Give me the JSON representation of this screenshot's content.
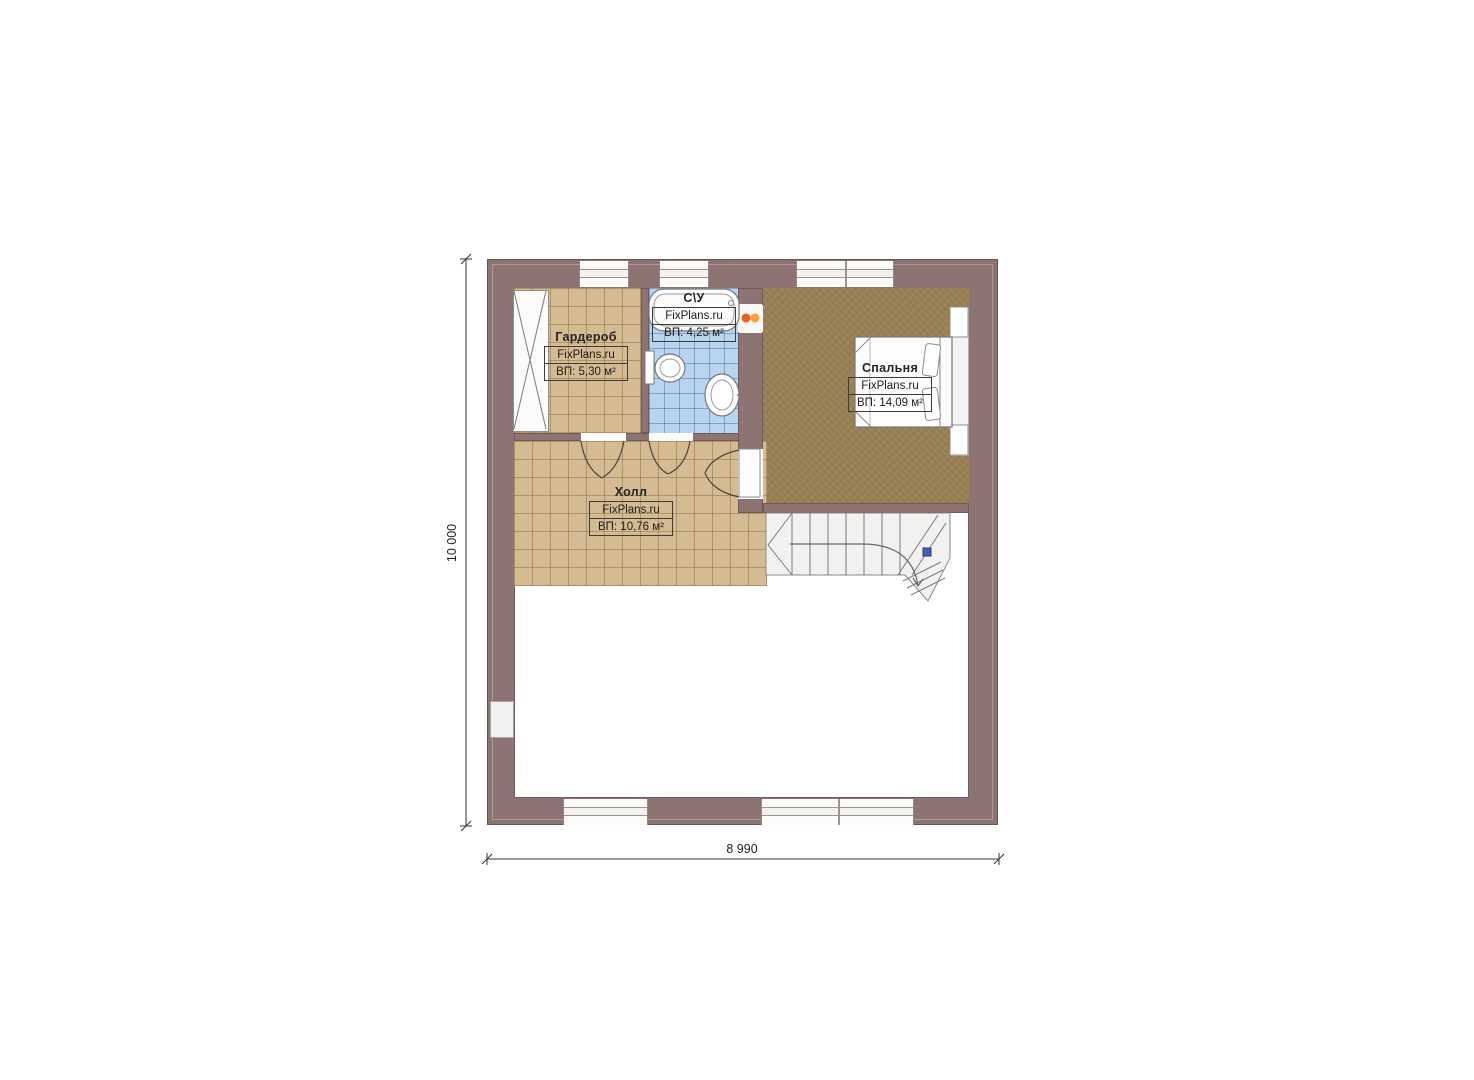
{
  "plan": {
    "rooms": [
      {
        "key": "wardrobe",
        "name": "Гардероб",
        "brand": "FixPlans.ru",
        "area": "ВП: 5,30 м²"
      },
      {
        "key": "bathroom",
        "name": "С\\У",
        "brand": "FixPlans.ru",
        "area": "ВП: 4,25 м²"
      },
      {
        "key": "bedroom",
        "name": "Спальня",
        "brand": "FixPlans.ru",
        "area": "ВП: 14,09 м²"
      },
      {
        "key": "hall",
        "name": "Холл",
        "brand": "FixPlans.ru",
        "area": "ВП: 10,76 м²"
      }
    ],
    "dimensions": {
      "width_label": "8 990",
      "height_label": "10 000"
    },
    "colors": {
      "wall": "#8d7472",
      "tile_tan": "#d4bb92",
      "tile_blue": "#b9d4ef",
      "carpet_brown": "#9a8153",
      "heater_orange": "#f07820",
      "stair_marker_blue": "#4a5fae"
    }
  }
}
